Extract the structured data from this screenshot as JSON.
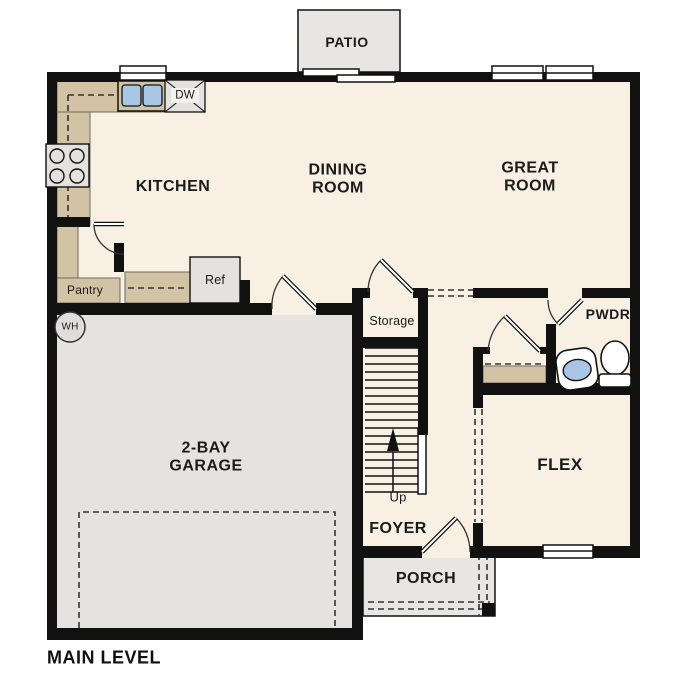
{
  "title": "MAIN LEVEL",
  "rooms": {
    "patio": "PATIO",
    "kitchen": "KITCHEN",
    "dining_room": "DINING\nROOM",
    "great_room": "GREAT\nROOM",
    "powder": "PWDR",
    "storage": "Storage",
    "garage": "2-BAY\nGARAGE",
    "flex": "FLEX",
    "foyer": "FOYER",
    "porch": "PORCH",
    "pantry": "Pantry"
  },
  "fixtures": {
    "refrigerator": "Ref",
    "dishwasher": "DW",
    "water_heater": "WH"
  },
  "stairs": {
    "direction_label": "Up"
  },
  "colors": {
    "wall": "#111111",
    "floor": "#f7f0e3",
    "garage_floor": "#e5e3df",
    "outdoor_concrete": "#e7e6e2",
    "counter": "#d2c3a5",
    "fixture_fill": "#e4e2df",
    "sink_water": "#a9c7e4"
  }
}
